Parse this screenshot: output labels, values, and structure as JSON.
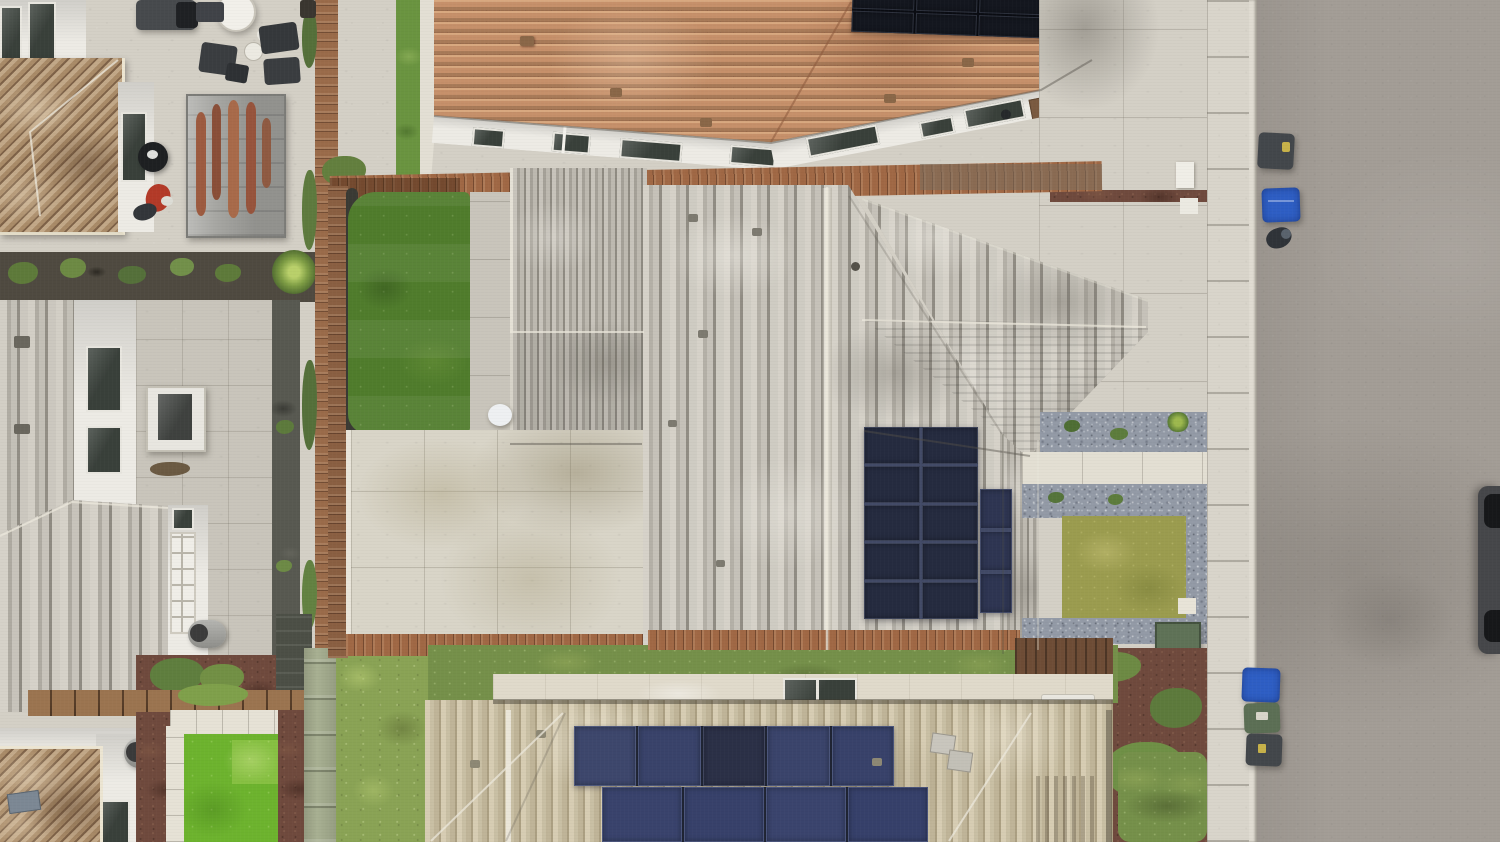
{
  "scene": {
    "type": "aerial-drone-photograph",
    "description": "Top-down overhead drone view of a suburban residential block: a central gray-shingled house with rooftop solar panels, a terracotta-tile roof house above it, a tan-roof house with a large solar array below it, neighbor houses and patios on the left, artificial turf yards, wooden fences, a front yard with gravel and lawn, and a sidewalk and asphalt street with trash bins on the right.",
    "lighting": "overcast daylight, no hard shadows"
  },
  "palette": {
    "concrete_light": "#d4d0c6",
    "paver": "#c9c5bb",
    "white_wall": "#edebe5",
    "cream_band": "#e0dacb",
    "window_dark": "#39403a",
    "terracotta_hi": "#d8a87f",
    "terracotta_mid": "#c6906a",
    "terracotta_dark": "#a87a58",
    "tan_roof_hi": "#d7cdb3",
    "tan_roof_mid": "#c9bfa4",
    "tan_roof_dark": "#ab9f82",
    "tl_roof_hi": "#c2a888",
    "tl_roof_mid": "#a98b68",
    "tl_roof_dark": "#7e6248",
    "shingle_hi": "#d6d2c9",
    "shingle_mid": "#b4b0a7",
    "shingle_dark": "#918d84",
    "turf_dark": "#507c2c",
    "turf_bright": "#6db32e",
    "lawn_olive": "#9b9c4f",
    "moss": "#8aa355",
    "scrub": "#75904a",
    "gravel": "#939aa6",
    "mulch": "#6f4a3d",
    "wood": "#9a6b4a",
    "wood_rust": "#a06845",
    "wood_dark": "#6e4d36",
    "sage_fence": "#a8b092",
    "dark_fence": "#4c4f46",
    "path_dark": "#585951",
    "green_box": "#5f7257",
    "bin_blue": "#2e5ec4",
    "bin_green": "#5c6f55",
    "bin_dark": "#43474b",
    "street": "#a39d96",
    "sidewalk": "#d9d5cb",
    "curb": "#e0dcd2",
    "car_body": "#46474a",
    "car_tire": "#17181a",
    "plant_green": "#5e7a3a",
    "plant_bright": "#79a04b",
    "surfboard": "#9d5b40",
    "tarp_gray": "#a6a6a2",
    "umbrella_white": "#f2f0ea",
    "red_toy": "#b33a28"
  },
  "solar": {
    "top": {
      "rows": 2,
      "cols": 4,
      "cell": "#14171f",
      "gap": "#0a0c12"
    },
    "center_main": {
      "rows": 5,
      "cols": 2,
      "cell": "#252b3f",
      "gap": "#424a66"
    },
    "center_col": {
      "rows": 3,
      "cols": 1,
      "cell": "#2e3552",
      "gap": "#424a66"
    },
    "bottom_row1": {
      "rows": 1,
      "cols": 5,
      "cells": [
        "#3d476c",
        "#39436a",
        "#2b3047",
        "#3a446b",
        "#38426a"
      ],
      "gap": "#1f2433"
    },
    "bottom_row2": {
      "rows": 1,
      "cols": 4,
      "cells": [
        "#39436c",
        "#37416a",
        "#3a446d",
        "#36406a"
      ],
      "gap": "#1f2433"
    }
  },
  "objects": {
    "houses": [
      {
        "name": "top-left-house",
        "roof": "tan-brown hip tiles",
        "features": [
          "patio furniture",
          "white cantilever umbrella",
          "bbq grill",
          "surfboard rack under gray cover",
          "kettle grill",
          "red kids scooter"
        ]
      },
      {
        "name": "rear-house-top-center",
        "roof": "terracotta spanish tile",
        "features": [
          "solar array 2x4 at ridge",
          "white stucco walls",
          "six dark windows",
          "concrete walkway",
          "large concrete driveway"
        ]
      },
      {
        "name": "center-house",
        "roof": "gray architectural shingle with right hip wing",
        "features": [
          "solar array 2x5 plus 3-panel column",
          "artificial turf backyard with rounded corner",
          "large stained concrete patio",
          "small gable garage roof",
          "front yard with gravel beds, olive lawn, green utility box"
        ]
      },
      {
        "name": "left-house-upper",
        "roof": "gray vertical-strip shingle",
        "features": [
          "white walls",
          "two windows",
          "paver patio",
          "white AC unit",
          "dark side path"
        ]
      },
      {
        "name": "left-house-lower",
        "roof": "gray vertical-strip shingle",
        "features": [
          "white french door",
          "gray wall vent cylinder"
        ]
      },
      {
        "name": "bottom-left-house",
        "roof": "tan tile corner",
        "features": [
          "white wall",
          "wall vent cylinder",
          "bright turf yard with white paver border",
          "red mulch beds",
          "sage green fence"
        ]
      },
      {
        "name": "bottom-house",
        "roof": "tan hip shingle",
        "features": [
          "cream ridge band with dark clerestory window",
          "solar rows of 5 and 4 panels",
          "two small rooftop vents",
          "drip stains"
        ]
      }
    ],
    "street_items": [
      {
        "name": "trash-bin-top-dark",
        "color_key": "bin_dark"
      },
      {
        "name": "trash-bin-top-blue",
        "color_key": "bin_blue"
      },
      {
        "name": "person-at-curb",
        "color": "#2f3338"
      },
      {
        "name": "trash-bin-bottom-blue",
        "color_key": "bin_blue"
      },
      {
        "name": "trash-bin-bottom-green",
        "color_key": "bin_green"
      },
      {
        "name": "trash-bin-bottom-dark",
        "color_key": "bin_dark"
      },
      {
        "name": "parked-car-partial",
        "color_key": "car_body"
      }
    ],
    "ground_covers": [
      "concrete patios",
      "artificial turf (dark and bright)",
      "olive front lawn",
      "mossy lawn",
      "scrubby lawn strip",
      "blue-gray gravel beds",
      "red-brown mulch",
      "dark rubber path"
    ],
    "fences": [
      "rusted brown rear fence",
      "wood side fences",
      "sage-green painted fence",
      "dark gray fence"
    ]
  }
}
